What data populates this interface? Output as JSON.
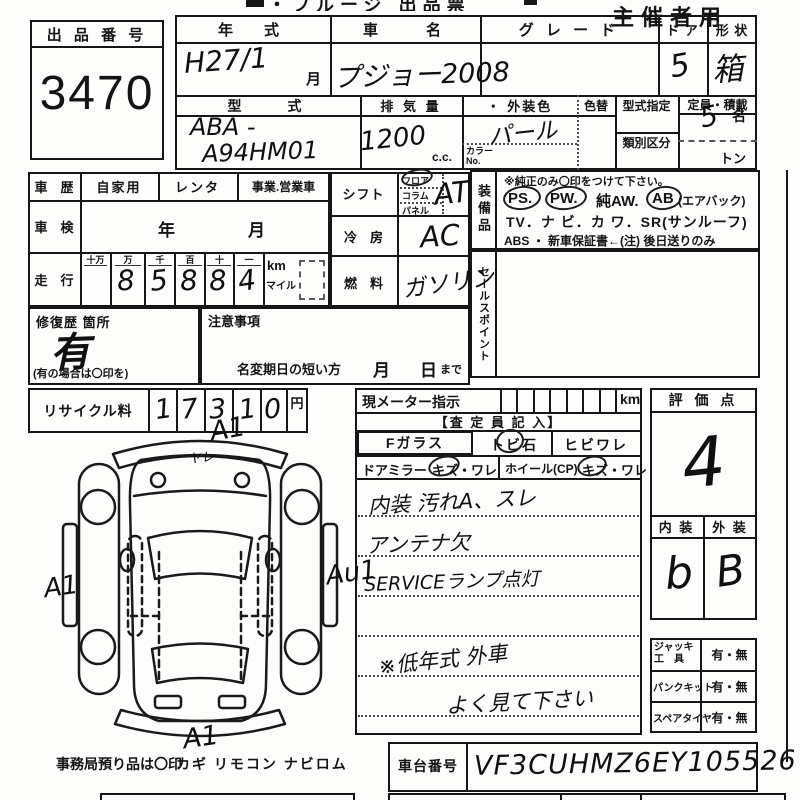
{
  "header": {
    "title_partial": "・フルージ 出品票",
    "organizer": "主催者用"
  },
  "lot": {
    "label": "出 品 番 号",
    "number": "3470"
  },
  "vehicle": {
    "year": {
      "label": "年　式",
      "value": "H27/1",
      "month_suffix": "月"
    },
    "name": {
      "label": "車　　名",
      "value": "プジョー2008"
    },
    "grade": {
      "label": "グ レ ー ド",
      "value": ""
    },
    "doors": {
      "label": "ド ア",
      "value": "5"
    },
    "shape": {
      "label": "形 状",
      "value": "箱"
    },
    "model_code": {
      "label": "型　　式",
      "line1": "ABA -",
      "line2": "A94HM01"
    },
    "displacement": {
      "label": "排 気 量",
      "value": "1200",
      "unit": "c.c."
    },
    "color": {
      "label": "・ 外装色",
      "value": "パール",
      "change_label": "色替",
      "no_label1": "カラー",
      "no_label2": "No."
    },
    "type_designation_label": "型式指定",
    "classification_label": "類別区分",
    "capacity": {
      "label": "定員・積載",
      "persons": "5",
      "persons_unit": "名",
      "ton_unit": "トン"
    }
  },
  "history": {
    "use": {
      "label": "車　歴",
      "opt1": "自家用",
      "opt2": "レンタ",
      "opt3": "事業.営業車"
    },
    "inspection": {
      "label": "車　検",
      "year_unit": "年",
      "month_unit": "月"
    },
    "mileage": {
      "label": "走　行",
      "cols": [
        "十万",
        "万",
        "千",
        "百",
        "十",
        "一"
      ],
      "digits": [
        "",
        "8",
        "5",
        "8",
        "8",
        "4"
      ],
      "km": "km",
      "mile": "マイル"
    },
    "repair": {
      "label": "修復歴 箇所",
      "value": "有",
      "note": "(有の場合は〇印を)"
    },
    "caution": {
      "label": "注意事項",
      "name_change": "名変期日の短い方",
      "month": "月",
      "day": "日",
      "made": "まで"
    },
    "recycle": {
      "label": "リサイクル料",
      "digits": [
        "1",
        "7",
        "3",
        "1",
        "0"
      ],
      "unit": "円"
    }
  },
  "specs": {
    "shift": {
      "label": "シフト",
      "opts": [
        "フロア",
        "コラム",
        "パネル"
      ],
      "value": "AT"
    },
    "ac": {
      "label": "冷　房",
      "value": "AC"
    },
    "fuel": {
      "label": "燃　料",
      "value": "ガソリン"
    }
  },
  "equipment": {
    "label": "装備品",
    "note": "※純正のみ〇印をつけて下さい。",
    "ps": "PS.",
    "pw": "PW.",
    "aw": "純AW.",
    "ab": "AB",
    "ab_note": "(エアバック)",
    "line3": "TV．ナ ビ．カ ワ．SR(サンルーフ)",
    "line4": "ABS ・ 新車保証書←(注) 後日送りのみ"
  },
  "sales_point_label": "セールスポイント",
  "assessment": {
    "meter_label": "現メーター指示",
    "meter_unit": "km",
    "assessor": "【査 定 員 記 入】",
    "f_glass": "Fガラス",
    "tobi": "トビ石",
    "hibi": "ヒビワレ",
    "mirror": "ドアミラー",
    "mirror_opt": "キズ・ワレ",
    "wheel": "ホイール(CP)",
    "wheel_opt": "キズ・ワレ",
    "notes": [
      "内装 汚れA、スレ",
      "アンテナ欠",
      "SERVICEランプ点灯",
      "※低年式 外車",
      "よく見て下さい"
    ]
  },
  "evaluation": {
    "label": "評 価 点",
    "score": "4",
    "interior_label": "内 装",
    "exterior_label": "外 装",
    "interior": "b",
    "exterior": "B"
  },
  "tools": {
    "rows": [
      {
        "label": "ジャッキ",
        "label2": "工　具",
        "value": "有・無"
      },
      {
        "label": "パンクキット",
        "label2": "",
        "value": "有・無"
      },
      {
        "label": "スペアタイヤ",
        "label2": "",
        "value": "有・無"
      }
    ]
  },
  "chassis": {
    "label": "車台番号",
    "value": "VF3CUHMZ6EY105526"
  },
  "office": {
    "label": "事務局預り品は〇印",
    "items": "カギ リモコン ナビロム"
  },
  "diagram": {
    "front": "A1",
    "left": "A1",
    "right": "Au1",
    "rear": "A1",
    "front_mark": "ヤレ"
  }
}
